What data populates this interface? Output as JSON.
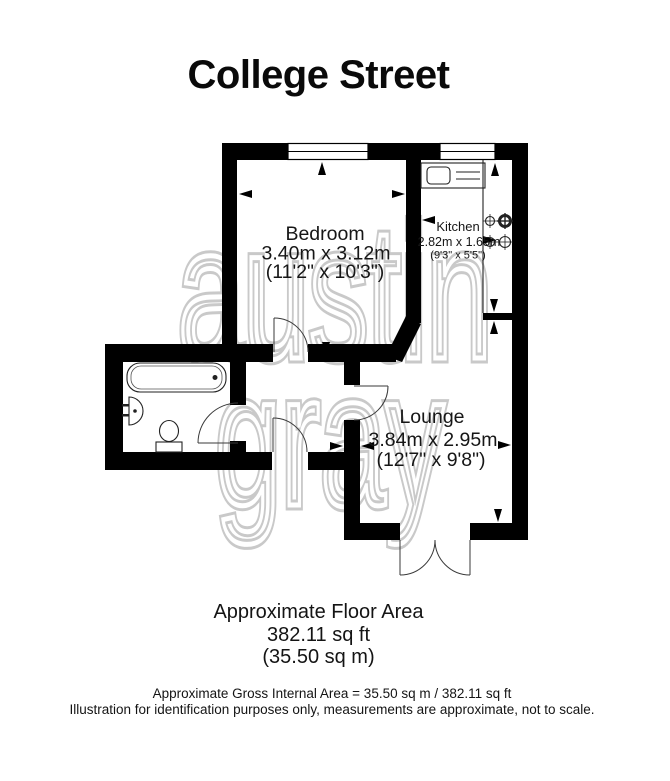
{
  "title": "College Street",
  "watermark": {
    "line1": "austin",
    "line2": "gray"
  },
  "rooms": {
    "bedroom": {
      "name": "Bedroom",
      "size_metric": "3.40m x 3.12m",
      "size_imperial": "(11'2\" x 10'3\")"
    },
    "kitchen": {
      "name": "Kitchen",
      "size_metric": "2.82m x 1.65m",
      "size_imperial": "(9'3\" x 5'5\")"
    },
    "lounge": {
      "name": "Lounge",
      "size_metric": "3.84m x 2.95m",
      "size_imperial": "(12'7\" x 9'8\")"
    }
  },
  "area_summary": {
    "heading": "Approximate Floor Area",
    "area_sqft": "382.11 sq ft",
    "area_sqm": "(35.50 sq m)"
  },
  "footer": {
    "gross_area": "Approximate Gross Internal Area = 35.50 sq m / 382.11 sq ft",
    "disclaimer": "Illustration for identification purposes only, measurements are approximate, not to scale."
  },
  "colors": {
    "wall": "#000000",
    "watermark": "#c9c9c9",
    "text": "#141414",
    "background": "#ffffff"
  }
}
